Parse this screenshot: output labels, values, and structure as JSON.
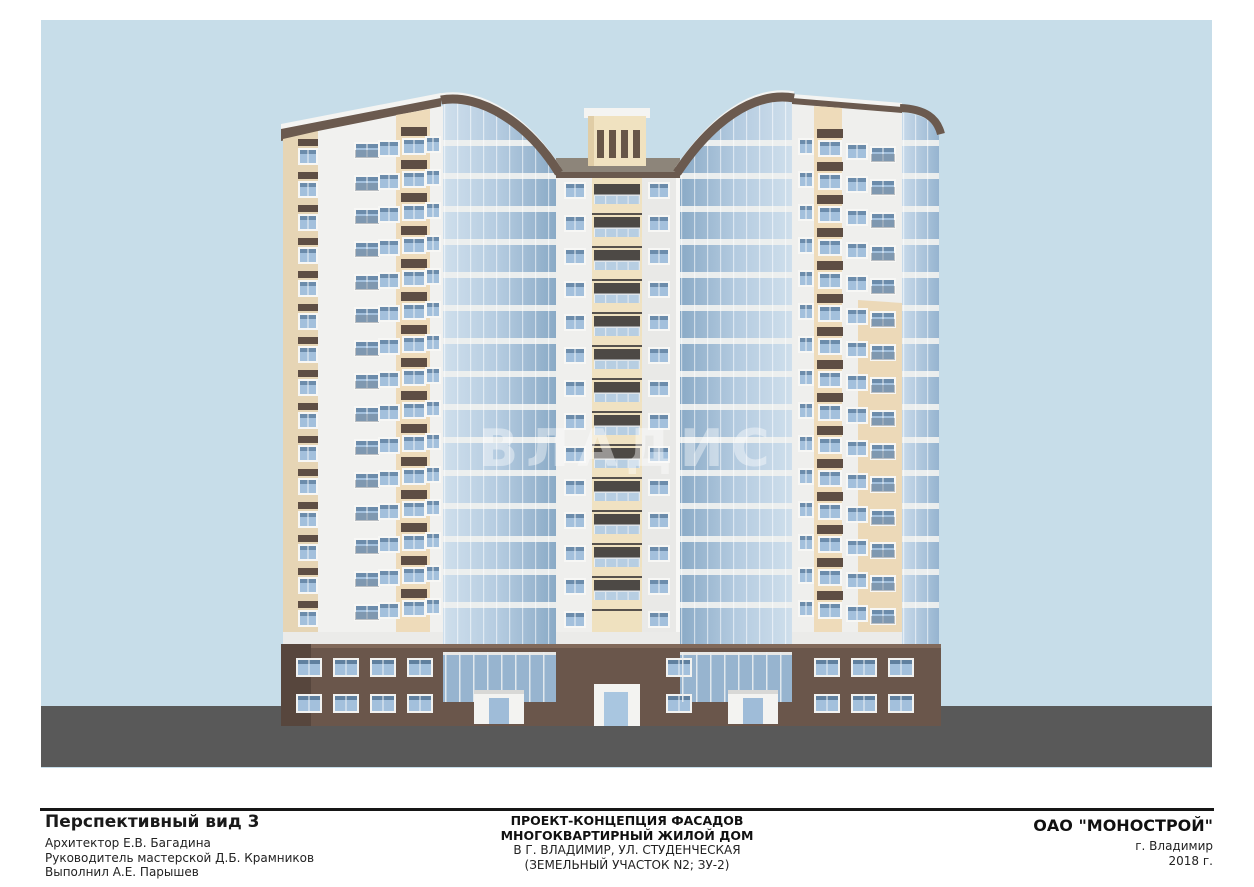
{
  "sheet": {
    "view_title": "Перспективный вид 3",
    "credits": {
      "architect": "Архитектор Е.В. Багадина",
      "studio_head": "Руководитель мастерской Д.Б. Крамников",
      "drafted_by": "Выполнил А.Е. Парышев"
    },
    "project": {
      "line1": "ПРОЕКТ-КОНЦЕПЦИЯ ФАСАДОВ",
      "line2": "МНОГОКВАРТИРНЫЙ ЖИЛОЙ ДОМ",
      "line3": "В Г. ВЛАДИМИР, УЛ. СТУДЕНЧЕСКАЯ",
      "line4": "(ЗЕМЕЛЬНЫЙ УЧАСТОК N2; ЗУ-2)"
    },
    "company": {
      "name": "ОАО \"МОНОСТРОЙ\"",
      "city": "г. Владимир",
      "year": "2018 г."
    }
  },
  "watermark": {
    "text": "ВЛАДИС"
  },
  "colors": {
    "sky": "#c7dde9",
    "ground": "#595959",
    "facade_white": "#f1f1ef",
    "facade_cream": "#eedbba",
    "cornice_brown": "#6b5a4f",
    "podium_brown": "#6a564b",
    "glazing_blue": "#a9c2dc"
  }
}
